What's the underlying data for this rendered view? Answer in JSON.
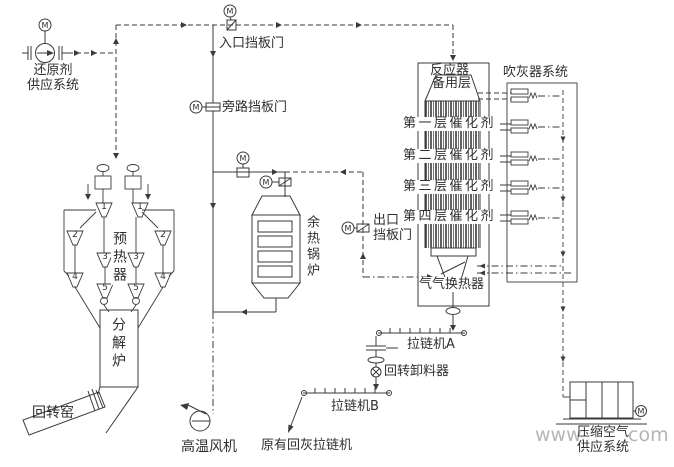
{
  "labels": {
    "reducing_agent": "还原剂\n供应系统",
    "inlet_damper": "入口挡板门",
    "bypass_damper": "旁路挡板门",
    "preheater": "预热器",
    "calciner": "分解炉",
    "rotary_kiln": "回转窑",
    "ht_fan": "高温风机",
    "waste_heat_boiler": "余热锅炉",
    "outlet_damper": "出口\n挡板门",
    "reactor": "反应器",
    "spare_layer": "备用层",
    "catalyst_layers": [
      "第一层催化剂",
      "第二层催化剂",
      "第三层催化剂",
      "第四层催化剂"
    ],
    "sootblower_system": "吹灰器系统",
    "gas_gas_heat_exchanger": "气气换热器",
    "chain_conveyor_a": "拉链机A",
    "rotary_discharger": "回转卸料器",
    "chain_conveyor_b": "拉链机B",
    "existing_ash_conveyor": "原有回灰拉链机",
    "compressed_air": "压缩空气\n供应系统"
  },
  "preheater_stages": [
    "1",
    "2",
    "3",
    "4",
    "5"
  ],
  "symbols": {
    "motor": "M"
  },
  "watermark": {
    "prefix": "www.",
    "suffix": ".com"
  },
  "colors": {
    "line": "#3a3a3a",
    "text": "#2f2f2f",
    "watermark": "#b5b5b5",
    "background": "#ffffff"
  }
}
